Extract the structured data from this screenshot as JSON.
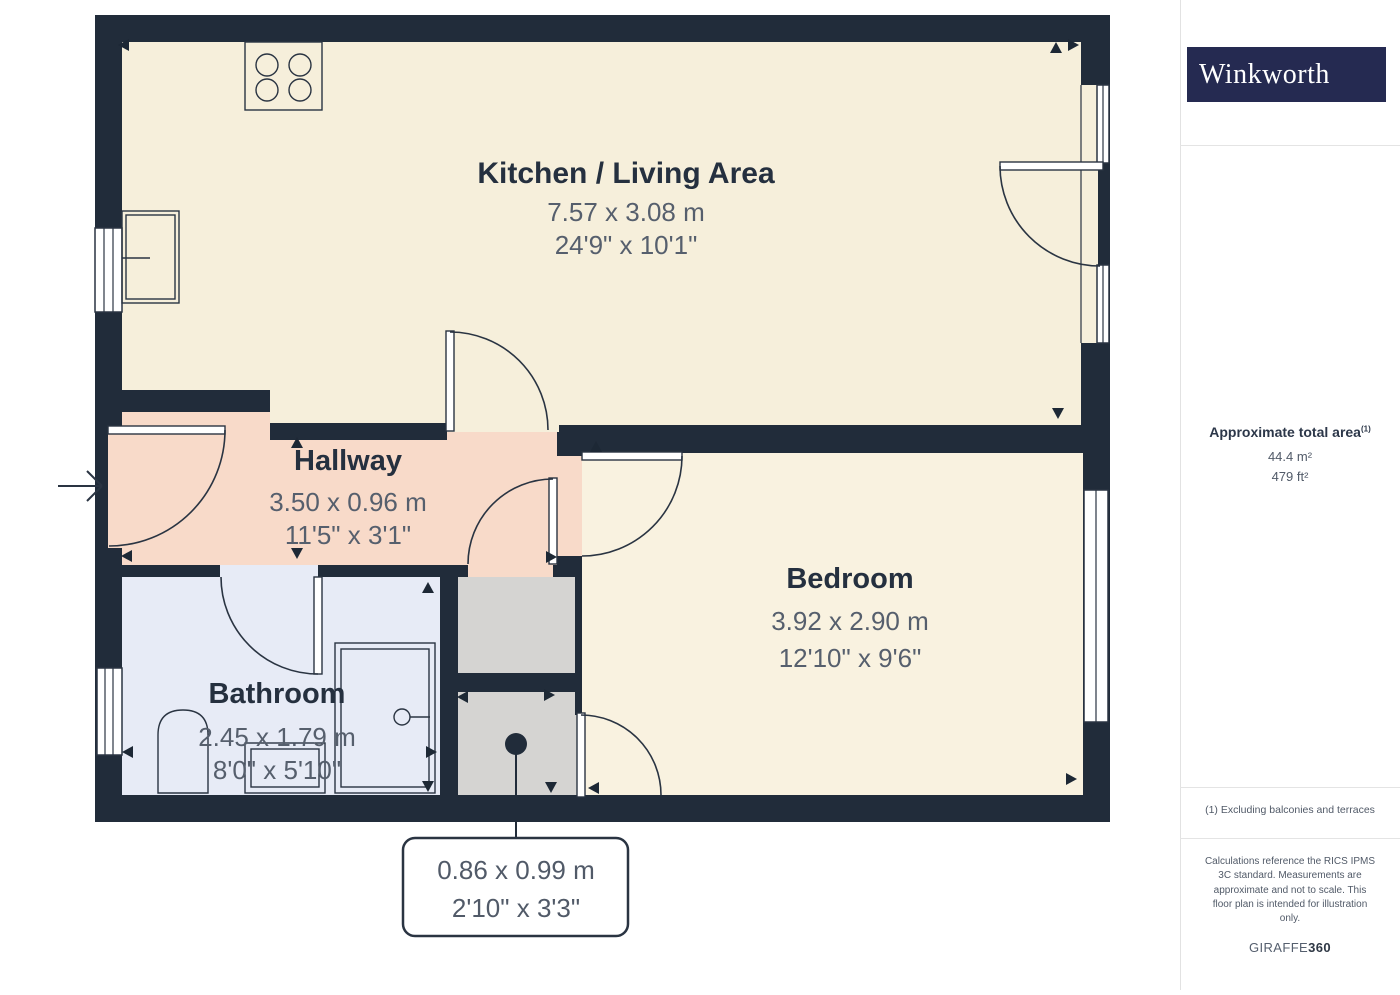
{
  "brand": {
    "name": "Winkworth"
  },
  "sidebar": {
    "area_title": "Approximate total area",
    "area_footnote_marker": "(1)",
    "area_metric": "44.4 m²",
    "area_imperial": "479 ft²",
    "footnote": "(1) Excluding balconies and terraces",
    "disclaimer": "Calculations reference the RICS IPMS 3C standard. Measurements are approximate and not to scale. This floor plan is intended for illustration only.",
    "credit_brand": "GIRAFFE",
    "credit_suffix": "360"
  },
  "floorplan": {
    "rooms": {
      "kitchen": {
        "name": "Kitchen / Living Area",
        "metric": "7.57 x 3.08 m",
        "imperial": "24'9\" x 10'1\""
      },
      "hallway": {
        "name": "Hallway",
        "metric": "3.50 x 0.96 m",
        "imperial": "11'5\" x 3'1\""
      },
      "bathroom": {
        "name": "Bathroom",
        "metric": "2.45 x 1.79 m",
        "imperial": "8'0\" x 5'10\""
      },
      "bedroom": {
        "name": "Bedroom",
        "metric": "3.92 x 2.90 m",
        "imperial": "12'10\" x 9'6\""
      },
      "store": {
        "metric": "0.86 x 0.99 m",
        "imperial": "2'10\" x 3'3\""
      }
    },
    "colors": {
      "wall": "#212c3a",
      "kitchen_floor": "#f6efdb",
      "bedroom_floor": "#f9f2e0",
      "hallway_floor": "#f8dac9",
      "bathroom_floor": "#e7ebf6",
      "store_floor": "#d5d4d2",
      "logo_background": "#252a51"
    }
  }
}
